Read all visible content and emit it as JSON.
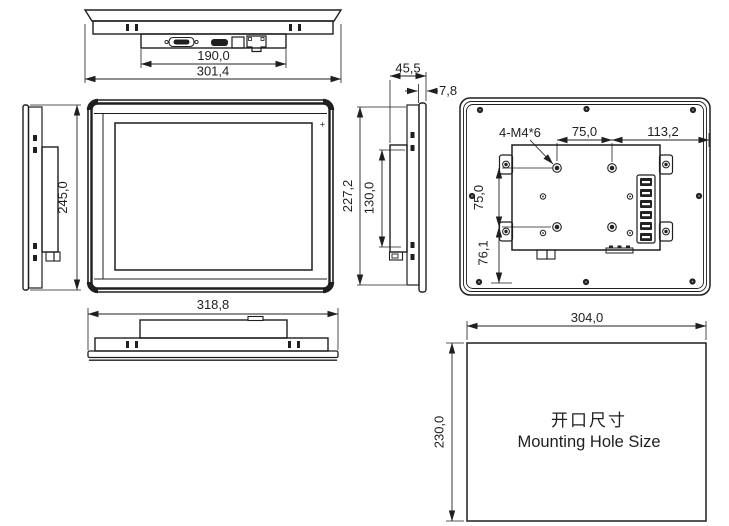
{
  "drawing": {
    "background": "#ffffff",
    "line_color": "#1f1f1f",
    "views": {
      "top": {
        "dim_io_width": "190,0",
        "dim_overall_width": "301,4"
      },
      "left_side": {
        "dim_overall_height": "245,0"
      },
      "front": {
        "power_led_mark": "+",
        "dim_overall_width": "318,8"
      },
      "side": {
        "dim_depth": "45,5",
        "dim_front_bezel": "7,8",
        "dim_body_height": "227,2",
        "dim_rear_box_height": "130,0"
      },
      "back": {
        "thread_callout": "4-M4*6",
        "dim_vesa_width": "75,0",
        "dim_edge_offset": "113,2",
        "dim_vesa_height": "75,0",
        "dim_lower_offset": "76,1"
      },
      "mounting_hole": {
        "dim_width": "304,0",
        "dim_height": "230,0",
        "title_zh": "开口尺寸",
        "title_en": "Mounting Hole Size"
      }
    }
  }
}
